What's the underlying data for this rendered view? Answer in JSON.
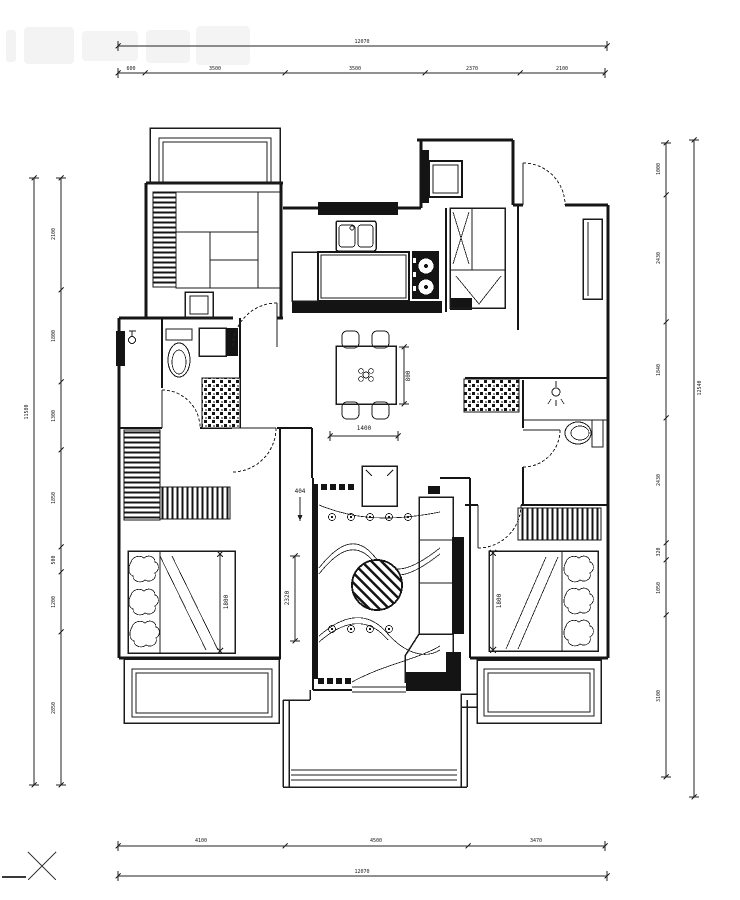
{
  "dimensions": {
    "top": {
      "overall": "12070",
      "segments": [
        "600",
        "3500",
        "3500",
        "2370",
        "2100"
      ]
    },
    "bottom": {
      "overall": "12070",
      "segments": [
        "4100",
        "4500",
        "3470"
      ]
    },
    "left": {
      "overall": "11580",
      "segments": [
        "2100",
        "1800",
        "1300",
        "1850",
        "500",
        "1200",
        "2850"
      ]
    },
    "right": {
      "overall": "12540",
      "segments": [
        "1000",
        "2430",
        "1840",
        "2430",
        "320",
        "1050",
        "3100"
      ]
    },
    "interior": {
      "dining_table_width": "1400",
      "dining_table_depth": "800",
      "left_bed_width": "1800",
      "right_bed_width": "1800",
      "living_room_width": "2320",
      "tv_niche_depth": "404"
    }
  }
}
